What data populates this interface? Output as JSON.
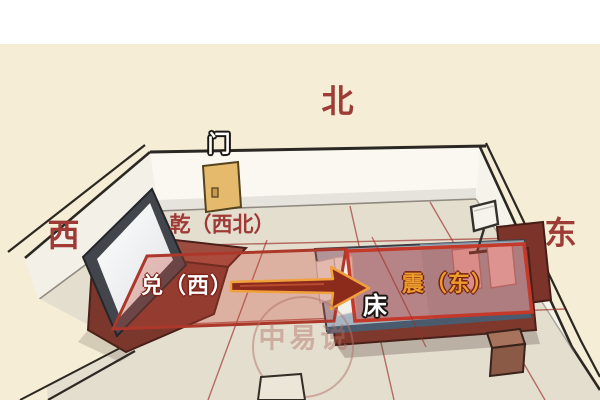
{
  "illustration": {
    "compass": {
      "north": "北",
      "west": "西",
      "east": "东"
    },
    "labels": {
      "door": "门",
      "zone_northwest": "乾（西北）",
      "zone_west": "兑（西）",
      "zone_east": "震（东）",
      "bed": "床"
    },
    "watermark": "中易说",
    "colors": {
      "page_background": "#f5edd5",
      "top_strip": "#ffffff",
      "floor": "#e4decf",
      "wall": "#faf8f1",
      "compass_text": "#9e3b36",
      "zone_band_border": "#ab382a",
      "zone_box_border": "#c4392a",
      "zone_east_text": "#eb9c2d",
      "arrow_fill": "#8c2a1c",
      "arrow_outline": "#f0a03c",
      "door_fill": "#e6ba6c",
      "bed_blanket": "#a7b5c2",
      "furniture_wood": "#8a4335"
    }
  }
}
